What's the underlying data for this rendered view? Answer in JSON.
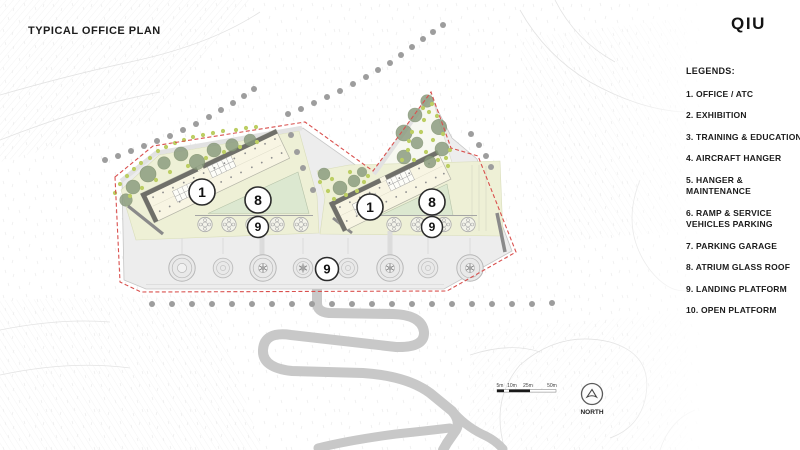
{
  "header": {
    "title": "TYPICAL OFFICE PLAN",
    "logo": "QIU"
  },
  "legend": {
    "heading": "LEGENDS:",
    "items": [
      "1. OFFICE / ATC",
      "2. EXHIBITION",
      "3. TRAINING & EDUCATION",
      "4. AIRCRAFT HANGER",
      "5. HANGER & MAINTENANCE",
      "6. RAMP & SERVICE VEHICLES PARKING",
      "7. PARKING GARAGE",
      "8. ATRIUM GLASS ROOF",
      "9. LANDING PLATFORM",
      "10. OPEN PLATFORM"
    ]
  },
  "plan": {
    "bubbles": {
      "left_office": "1",
      "left_atrium": "8",
      "left_landing": "9",
      "right_office": "1",
      "right_atrium": "8",
      "right_landing": "9",
      "central_landing": "9"
    },
    "scale_bar": {
      "labels": {
        "s5": "5m",
        "s10": "10m",
        "s25": "25m",
        "s50": "50m"
      }
    },
    "north": {
      "label": "NORTH"
    }
  },
  "colors": {
    "boundary_red": "#d9504e",
    "lawn_green": "#eef0d6",
    "atrium_green": "#dce8d0",
    "tree_green": "#87997b",
    "accent_lime": "#bcce63",
    "platform_gray": "#ededed",
    "road_gray": "#c8c8c8",
    "building_cream": "#f8f5e3",
    "wall_dark": "#6f6f69"
  }
}
